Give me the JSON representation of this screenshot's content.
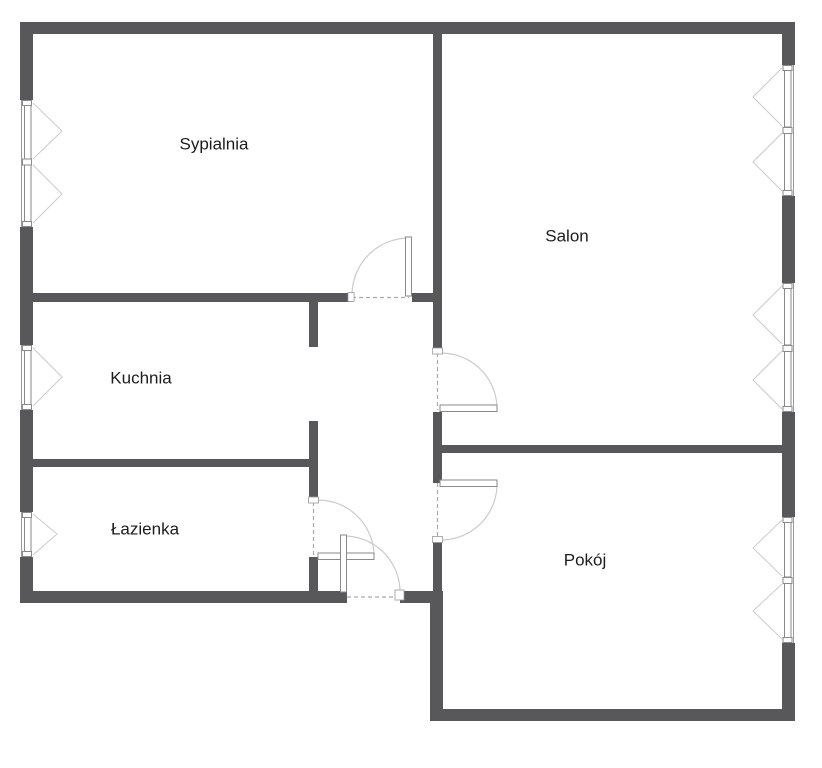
{
  "plan": {
    "kind": "apartment-floor-plan",
    "rooms": [
      {
        "id": "sypialnia",
        "label": "Sypialnia"
      },
      {
        "id": "salon",
        "label": "Salon"
      },
      {
        "id": "kuchnia",
        "label": "Kuchnia"
      },
      {
        "id": "lazienka",
        "label": "Łazienka"
      },
      {
        "id": "pokoj",
        "label": "Pokój"
      }
    ]
  },
  "colors": {
    "wall": "#58585a",
    "symbol": "#8a8a8a",
    "symbol_light": "#cbcbcb",
    "dash": "#ababab",
    "text": "#1c1c1c",
    "background": "#ffffff"
  }
}
